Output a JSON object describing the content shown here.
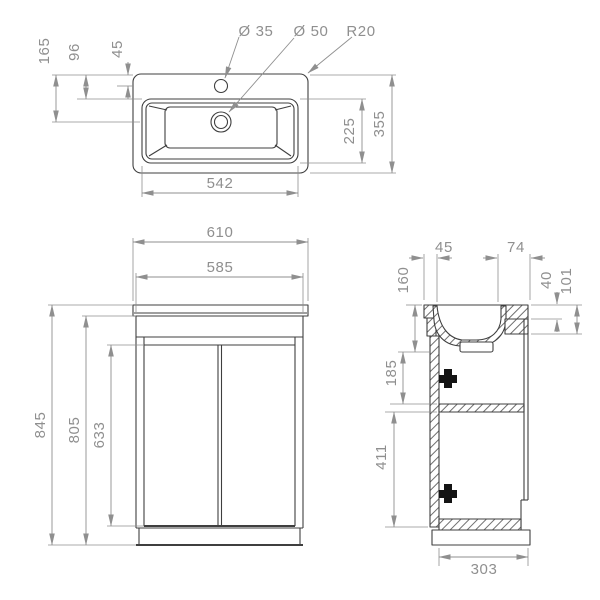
{
  "colors": {
    "background": "#ffffff",
    "drawing_line": "#3f3f3f",
    "dimension": "#8f8f8f",
    "hatch": "#5f5f5f"
  },
  "top_view": {
    "labels": {
      "drain_offset": "165",
      "rim_offset": "96",
      "tap_offset": "45",
      "tap_hole_diameter": "Ø 35",
      "drain_diameter": "Ø 50",
      "corner_radius": "R20",
      "basin_inner_depth": "225",
      "total_depth": "355",
      "basin_inner_width": "542"
    }
  },
  "front_view": {
    "labels": {
      "total_width": "610",
      "cabinet_width": "585",
      "total_height": "845",
      "cabinet_height": "805",
      "door_height": "633"
    }
  },
  "side_view": {
    "labels": {
      "front_overhang": "45",
      "back_ledge": "74",
      "basin_depth_height": "160",
      "deck_thickness": "40",
      "back_apron_height": "101",
      "upper_section": "185",
      "lower_section": "411",
      "cabinet_depth": "303"
    }
  }
}
